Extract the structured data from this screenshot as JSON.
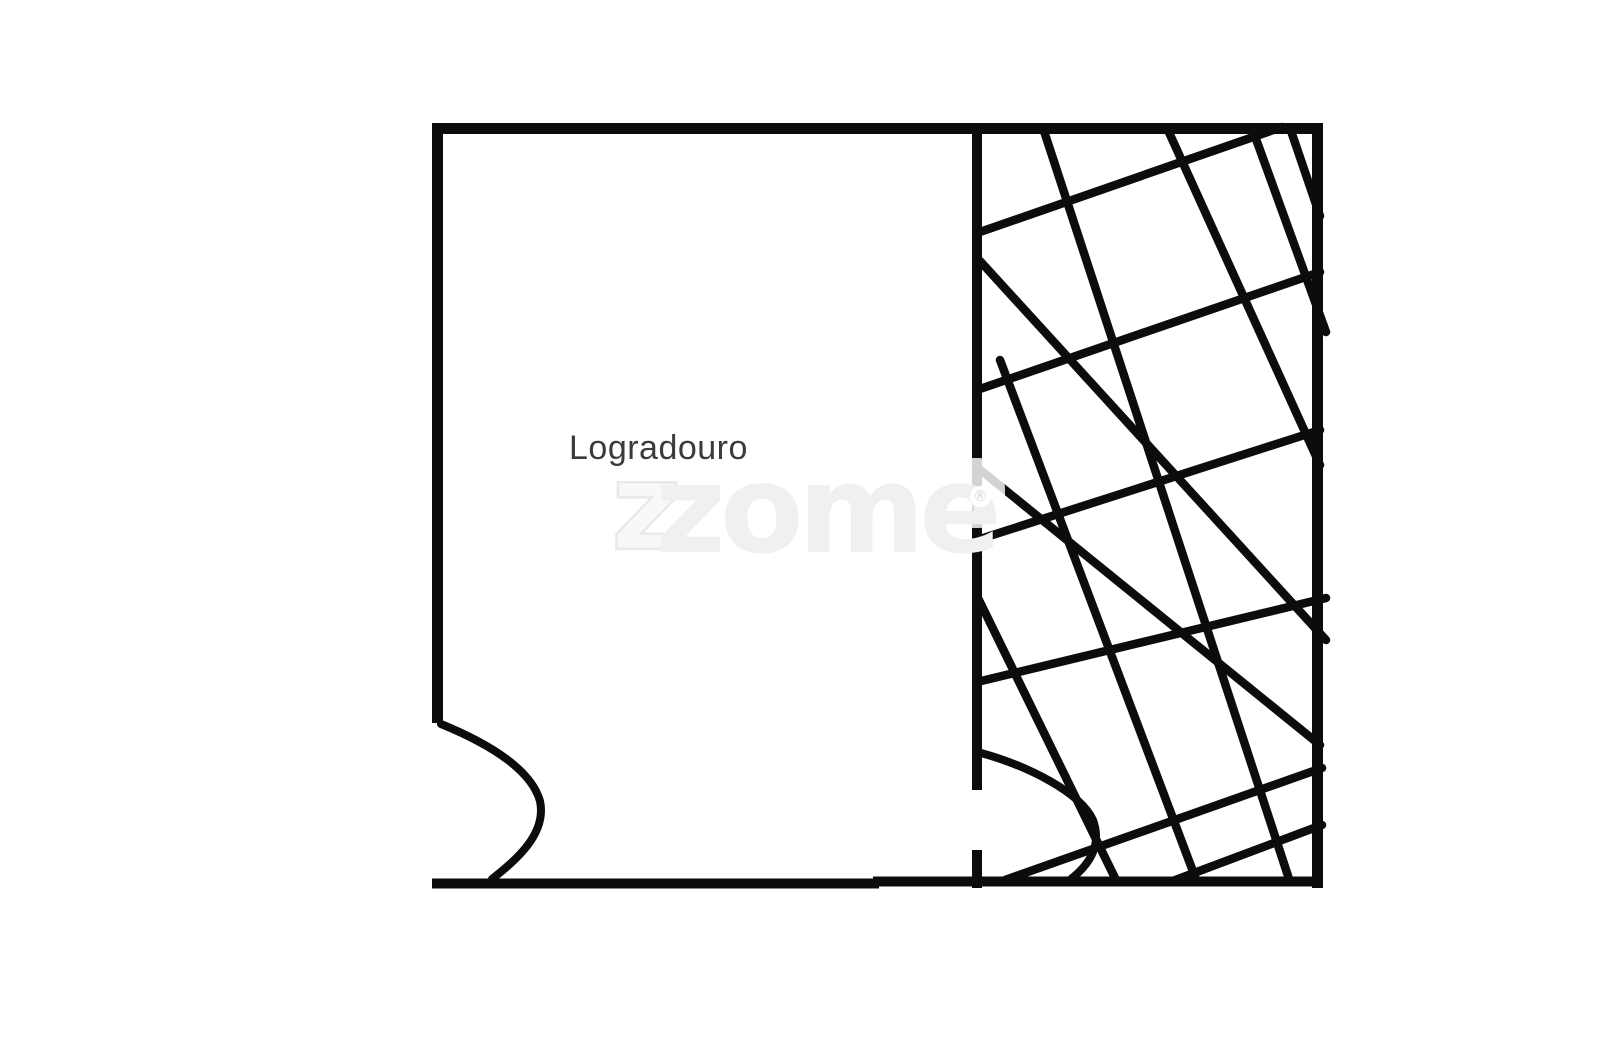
{
  "page": {
    "width": 1600,
    "height": 1062,
    "background": "#ffffff"
  },
  "plan": {
    "room_label": "Logradouro",
    "room_label_color": "#3b3b3b",
    "stroke_color": "#0c0c0c",
    "walls": [
      {
        "x1": 432,
        "y1": 128.5,
        "x2": 1323,
        "y2": 128.5,
        "w": 11,
        "name": "top-wall"
      },
      {
        "x1": 437.5,
        "y1": 123,
        "x2": 437.5,
        "y2": 723,
        "w": 11,
        "name": "left-wall"
      },
      {
        "x1": 1317.5,
        "y1": 123,
        "x2": 1317.5,
        "y2": 888,
        "w": 11,
        "name": "right-wall"
      },
      {
        "x1": 432,
        "y1": 883.5,
        "x2": 879,
        "y2": 883.5,
        "w": 10,
        "name": "bottom-wall-left"
      },
      {
        "x1": 873,
        "y1": 881.5,
        "x2": 1323,
        "y2": 881.5,
        "w": 10,
        "name": "bottom-wall-right"
      },
      {
        "x1": 977,
        "y1": 123,
        "x2": 977,
        "y2": 790,
        "w": 10,
        "name": "divider-wall"
      },
      {
        "x1": 977,
        "y1": 850,
        "x2": 977,
        "y2": 888,
        "w": 10,
        "name": "divider-wall-stub"
      }
    ],
    "door_arcs": [
      {
        "d": "M 441 724 C 480 740 530 766 540 801 C 547 834 516 860 492 879",
        "name": "left-door-swing"
      },
      {
        "d": "M 981 753 C 1028 766 1080 792 1093 820 C 1102 845 1090 864 1071 879",
        "name": "right-door-swing"
      }
    ],
    "hatch_down": [
      [
        1290,
        128,
        1320,
        216
      ],
      [
        1252,
        128,
        1326,
        332
      ],
      [
        1167,
        128,
        1320,
        465
      ],
      [
        1043,
        128,
        1290,
        882
      ],
      [
        980,
        261,
        1326,
        640
      ],
      [
        1000,
        360,
        1197,
        882
      ],
      [
        978,
        468,
        1320,
        745
      ],
      [
        977,
        596,
        1117,
        882
      ]
    ],
    "hatch_up": [
      [
        977,
        233,
        1282,
        127
      ],
      [
        977,
        390,
        1320,
        272
      ],
      [
        977,
        540,
        1320,
        430
      ],
      [
        977,
        682,
        1326,
        598
      ],
      [
        1005,
        880,
        1322,
        768
      ],
      [
        1170,
        882,
        1322,
        825
      ]
    ],
    "hatch_width": 8.5,
    "wall_cap": "butt",
    "hatch_cap": "round"
  },
  "watermark": {
    "z_outline": "z",
    "brand": "zome",
    "registered": "®",
    "fill_color": "#f0f0f0",
    "outline_color": "#e9e9e9"
  }
}
